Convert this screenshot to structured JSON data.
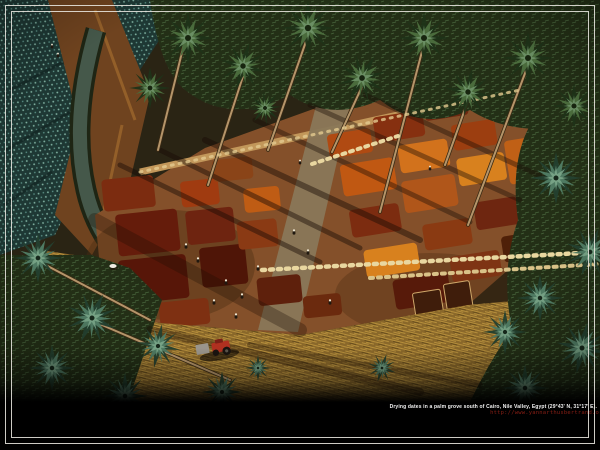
{
  "caption": {
    "title": "Drying dates in a palm grove south of Cairo, Nile Valley, Egypt (29°43' N, 31°17' E).",
    "url": "http://www.yannarthusbertrand.org"
  },
  "photo": {
    "subject": "aerial-view-drying-dates-palm-grove",
    "location": "Nile Valley, Egypt"
  },
  "palette": {
    "frame_color": "#e9e7e0",
    "caption_text": "#f2f2f2",
    "caption_url": "#8a1f15",
    "band_color": "#000000",
    "field_red": "#a03c12",
    "field_orange": "#d2721c",
    "palm_green": "#3f5d33",
    "teal_crop": "#2a4a44",
    "straw_gold": "#a8812f",
    "tractor_red": "#b03020"
  }
}
